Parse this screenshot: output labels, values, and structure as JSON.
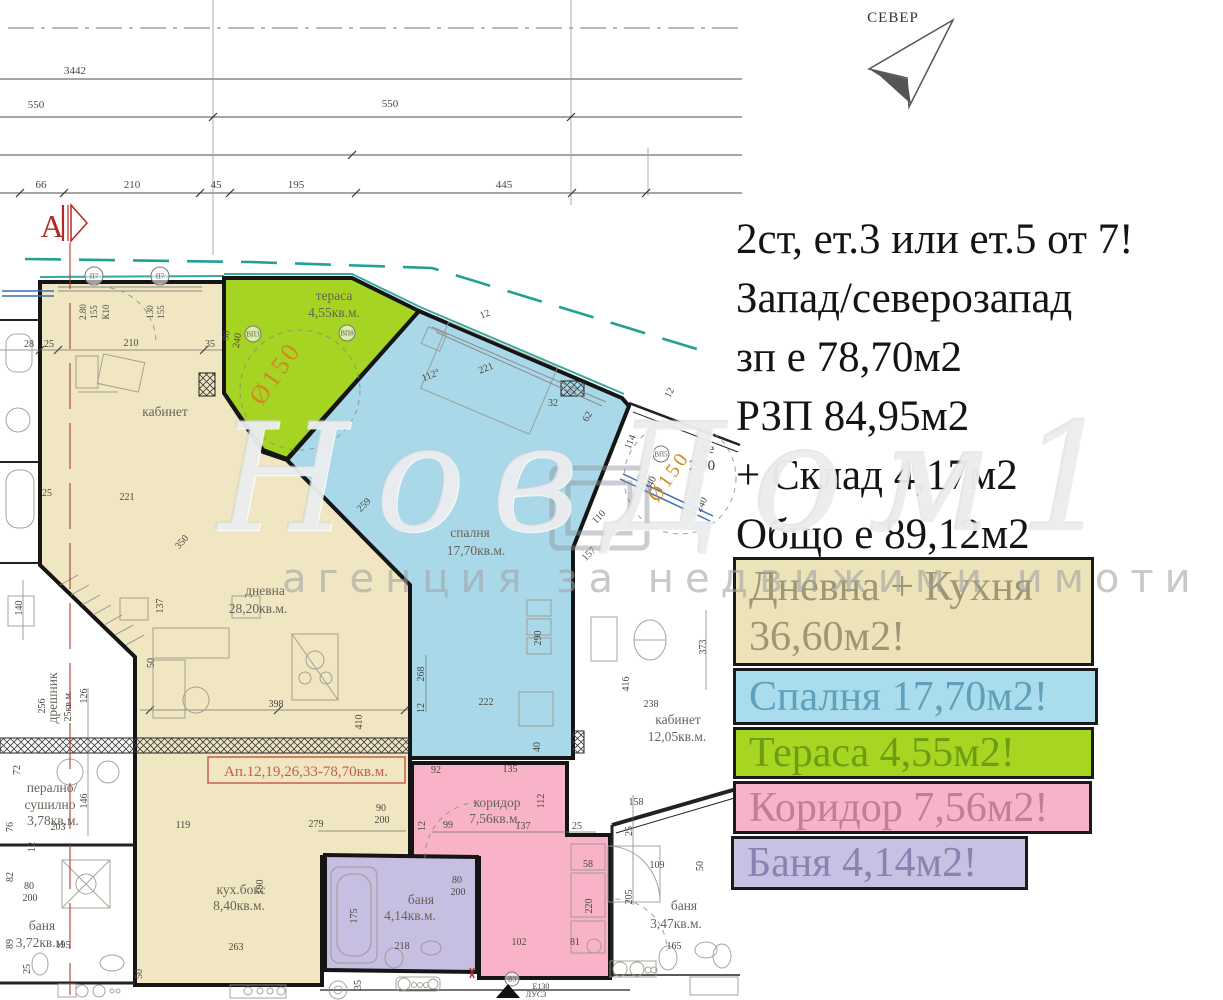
{
  "north": {
    "label": "СЕВЕР"
  },
  "info": {
    "lines": [
      "2ст, ет.3 или ет.5 от 7!",
      "Запад/северозапад",
      "зп е 78,70м2",
      "РЗП 84,95м2",
      "+ Склад 4,17м2",
      "Общо е 89,12м2"
    ]
  },
  "legend": {
    "boxes": [
      {
        "label": "living-kitchen",
        "lines": [
          "Дневна + Кухня",
          "36,60м2!"
        ],
        "x": 733,
        "y": 557,
        "w": 361,
        "h": 109,
        "fill": "#ece3b8",
        "color": "#9e9674"
      },
      {
        "label": "bedroom",
        "lines": [
          "Спалня 17,70м2!"
        ],
        "x": 733,
        "y": 668,
        "w": 365,
        "h": 57,
        "fill": "#a9dcec",
        "color": "#5fa0ba"
      },
      {
        "label": "terrace",
        "lines": [
          "Тераса 4,55м2!"
        ],
        "x": 733,
        "y": 727,
        "w": 361,
        "h": 52,
        "fill": "#a6d622",
        "color": "#6f9c14"
      },
      {
        "label": "corridor",
        "lines": [
          "Коридор 7,56м2!"
        ],
        "x": 733,
        "y": 781,
        "w": 359,
        "h": 53,
        "fill": "#f7b4c9",
        "color": "#c47d98"
      },
      {
        "label": "bath",
        "lines": [
          "Баня 4,14м2!"
        ],
        "x": 731,
        "y": 836,
        "w": 297,
        "h": 54,
        "fill": "#c7c1e3",
        "color": "#8a82b0"
      }
    ]
  },
  "watermark": {
    "brand": "НовДом1",
    "tagline": "агенция за недвижими имоти"
  },
  "plan": {
    "colors": {
      "wall": "#151515",
      "teal": "#21a093",
      "red": "#b22820",
      "orange": "#d08a1f",
      "dim": "#4a4841",
      "label": "#67645a"
    },
    "rooms": [
      {
        "name": "living-kitchen",
        "fill": "#f0e6c2",
        "points": "40,282 224,282 224,393 263,452 287,460 410,583 410,857 322,857 322,985 135,985 135,657 40,565"
      },
      {
        "name": "terrace",
        "fill": "#a6d422",
        "points": "224,278 352,278 419,311 287,459 263,450 224,393"
      },
      {
        "name": "bedroom",
        "fill": "#a9d9e9",
        "points": "419,311 622,398 629,406 573,548 573,758 410,758 410,585 287,460"
      },
      {
        "name": "corridor",
        "fill": "#f8b3c8",
        "points": "412,763 567,763 567,835 610,835 610,978 479,978 479,858 412,858"
      },
      {
        "name": "bath",
        "fill": "#c6bfe2",
        "points": "325,855 477,857 477,972 325,970"
      }
    ],
    "room_labels": [
      {
        "t": "кабинет",
        "x": 165,
        "y": 416
      },
      {
        "t": "дневна",
        "x": 265,
        "y": 595
      },
      {
        "t": "28,20кв.м.",
        "x": 258,
        "y": 613
      },
      {
        "t": "тераса",
        "x": 334,
        "y": 300
      },
      {
        "t": "4,55кв.м.",
        "x": 334,
        "y": 317
      },
      {
        "t": "спалня",
        "x": 470,
        "y": 537
      },
      {
        "t": "17,70кв.м.",
        "x": 476,
        "y": 555
      },
      {
        "t": "коридор",
        "x": 497,
        "y": 807
      },
      {
        "t": "7,56кв.м.",
        "x": 495,
        "y": 823
      },
      {
        "t": "баня",
        "x": 421,
        "y": 904
      },
      {
        "t": "4,14кв.м.",
        "x": 410,
        "y": 920
      },
      {
        "t": "кух.бокс",
        "x": 241,
        "y": 894
      },
      {
        "t": "8,40кв.м.",
        "x": 239,
        "y": 910
      },
      {
        "t": "кабинет",
        "x": 678,
        "y": 724
      },
      {
        "t": "12,05кв.м.",
        "x": 677,
        "y": 741
      },
      {
        "t": "баня",
        "x": 684,
        "y": 910
      },
      {
        "t": "3,47кв.м.",
        "x": 676,
        "y": 928
      },
      {
        "t": "перално/",
        "x": 52,
        "y": 792
      },
      {
        "t": "сушилно",
        "x": 50,
        "y": 809
      },
      {
        "t": "3,78кв.м.",
        "x": 53,
        "y": 825
      },
      {
        "t": "баня",
        "x": 42,
        "y": 930
      },
      {
        "t": "3,72кв.м",
        "x": 40,
        "y": 947
      },
      {
        "t": "дрешник",
        "x": 57,
        "y": 698,
        "r": -90
      }
    ],
    "unit_label": {
      "t": "Ап.12,19,26,33-78,70кв.м.",
      "x": 306,
      "y": 776,
      "box": [
        208,
        757,
        197,
        26
      ],
      "color": "#c2604a"
    },
    "top_labels": [
      {
        "t": "3442",
        "x": 75,
        "y": 74
      },
      {
        "t": "550",
        "x": 36,
        "y": 108
      },
      {
        "t": "550",
        "x": 390,
        "y": 107
      },
      {
        "t": "66",
        "x": 41,
        "y": 188
      },
      {
        "t": "210",
        "x": 132,
        "y": 188
      },
      {
        "t": "45",
        "x": 216,
        "y": 188
      },
      {
        "t": "195",
        "x": 296,
        "y": 188
      },
      {
        "t": "445",
        "x": 504,
        "y": 188
      }
    ],
    "dims": [
      {
        "t": "28",
        "x": 29,
        "y": 347
      },
      {
        "t": "25",
        "x": 49,
        "y": 347
      },
      {
        "t": "210",
        "x": 131,
        "y": 346
      },
      {
        "t": "35",
        "x": 210,
        "y": 347
      },
      {
        "t": "25",
        "x": 47,
        "y": 496
      },
      {
        "t": "221",
        "x": 127,
        "y": 500
      },
      {
        "t": "140",
        "x": 22,
        "y": 608,
        "r": -90
      },
      {
        "t": "137",
        "x": 163,
        "y": 606,
        "r": -90
      },
      {
        "t": "350",
        "x": 184,
        "y": 544,
        "r": -48
      },
      {
        "t": "50",
        "x": 154,
        "y": 663,
        "r": -90
      },
      {
        "t": "256",
        "x": 45,
        "y": 706,
        "r": -90
      },
      {
        "t": "25кв.м.",
        "x": 71,
        "y": 706,
        "r": -90
      },
      {
        "t": "126",
        "x": 87,
        "y": 696,
        "r": -90
      },
      {
        "t": "146",
        "x": 87,
        "y": 801,
        "r": -90
      },
      {
        "t": "203",
        "x": 58,
        "y": 830
      },
      {
        "t": "76",
        "x": 13,
        "y": 827,
        "r": -90
      },
      {
        "t": "12",
        "x": 35,
        "y": 847,
        "r": -90
      },
      {
        "t": "72",
        "x": 20,
        "y": 770,
        "r": -90
      },
      {
        "t": "80",
        "x": 29,
        "y": 889
      },
      {
        "t": "200",
        "x": 30,
        "y": 901
      },
      {
        "t": "82",
        "x": 13,
        "y": 877,
        "r": -90
      },
      {
        "t": "89",
        "x": 13,
        "y": 944,
        "r": -90
      },
      {
        "t": "195",
        "x": 63,
        "y": 948
      },
      {
        "t": "25",
        "x": 30,
        "y": 969,
        "r": -90
      },
      {
        "t": "190",
        "x": 263,
        "y": 887,
        "r": -90
      },
      {
        "t": "119",
        "x": 183,
        "y": 828
      },
      {
        "t": "279",
        "x": 316,
        "y": 827
      },
      {
        "t": "263",
        "x": 236,
        "y": 950
      },
      {
        "t": "50",
        "x": 142,
        "y": 974,
        "r": -90
      },
      {
        "t": "35",
        "x": 361,
        "y": 985,
        "r": -90
      },
      {
        "t": "398",
        "x": 276,
        "y": 707
      },
      {
        "t": "410",
        "x": 362,
        "y": 722,
        "r": -90
      },
      {
        "t": "90",
        "x": 381,
        "y": 811
      },
      {
        "t": "200",
        "x": 382,
        "y": 823
      },
      {
        "t": "221",
        "x": 487,
        "y": 371,
        "r": -22
      },
      {
        "t": "112°",
        "x": 432,
        "y": 378,
        "r": -22
      },
      {
        "t": "12",
        "x": 486,
        "y": 317,
        "r": -22
      },
      {
        "t": "32",
        "x": 553,
        "y": 406
      },
      {
        "t": "62",
        "x": 590,
        "y": 418,
        "r": -62
      },
      {
        "t": "259",
        "x": 366,
        "y": 507,
        "r": -46
      },
      {
        "t": "268",
        "x": 424,
        "y": 674,
        "r": -90
      },
      {
        "t": "12",
        "x": 424,
        "y": 708,
        "r": -90
      },
      {
        "t": "290",
        "x": 541,
        "y": 638,
        "r": -90
      },
      {
        "t": "222",
        "x": 486,
        "y": 705
      },
      {
        "t": "40",
        "x": 540,
        "y": 747,
        "r": -90
      },
      {
        "t": "90",
        "x": 229,
        "y": 336,
        "r": -80
      },
      {
        "t": "240",
        "x": 240,
        "y": 341,
        "r": -80
      },
      {
        "t": "90",
        "x": 645,
        "y": 477,
        "r": -62
      },
      {
        "t": "240",
        "x": 653,
        "y": 485,
        "r": -62
      },
      {
        "t": "114",
        "x": 633,
        "y": 443,
        "r": -68
      },
      {
        "t": "200",
        "x": 696,
        "y": 498,
        "r": -62
      },
      {
        "t": "240",
        "x": 704,
        "y": 506,
        "r": -62
      },
      {
        "t": "110",
        "x": 601,
        "y": 519,
        "r": -46
      },
      {
        "t": "157",
        "x": 591,
        "y": 556,
        "r": -46
      },
      {
        "t": "12",
        "x": 672,
        "y": 394,
        "r": -62
      },
      {
        "t": "373",
        "x": 706,
        "y": 647,
        "r": -90
      },
      {
        "t": "416",
        "x": 629,
        "y": 684,
        "r": -90
      },
      {
        "t": "238",
        "x": 651,
        "y": 707
      },
      {
        "t": "158",
        "x": 636,
        "y": 805
      },
      {
        "t": "25",
        "x": 632,
        "y": 831,
        "r": -90
      },
      {
        "t": "109",
        "x": 657,
        "y": 868
      },
      {
        "t": "205",
        "x": 632,
        "y": 897,
        "r": -90
      },
      {
        "t": "165",
        "x": 674,
        "y": 949
      },
      {
        "t": "50",
        "x": 703,
        "y": 866,
        "r": -90
      },
      {
        "t": "92",
        "x": 436,
        "y": 773
      },
      {
        "t": "135",
        "x": 510,
        "y": 772
      },
      {
        "t": "12",
        "x": 425,
        "y": 826,
        "r": -90
      },
      {
        "t": "99",
        "x": 448,
        "y": 828
      },
      {
        "t": "137",
        "x": 523,
        "y": 829
      },
      {
        "t": "112",
        "x": 544,
        "y": 801,
        "r": -90
      },
      {
        "t": "25",
        "x": 577,
        "y": 829
      },
      {
        "t": "58",
        "x": 588,
        "y": 867
      },
      {
        "t": "220",
        "x": 592,
        "y": 906,
        "r": -90
      },
      {
        "t": "80",
        "x": 457,
        "y": 883
      },
      {
        "t": "200",
        "x": 458,
        "y": 895
      },
      {
        "t": "102",
        "x": 519,
        "y": 945
      },
      {
        "t": "81",
        "x": 575,
        "y": 945
      },
      {
        "t": "218",
        "x": 402,
        "y": 949
      },
      {
        "t": "175",
        "x": 357,
        "y": 916,
        "r": -90
      },
      {
        "t": "2.80",
        "x": 86,
        "y": 312,
        "r": -90,
        "s": 9
      },
      {
        "t": "155",
        "x": 97,
        "y": 312,
        "r": -90,
        "s": 9
      },
      {
        "t": "К10",
        "x": 109,
        "y": 312,
        "r": -90,
        "s": 9
      },
      {
        "t": "130",
        "x": 153,
        "y": 312,
        "r": -90,
        "s": 9
      },
      {
        "t": "155",
        "x": 164,
        "y": 312,
        "r": -90,
        "s": 9
      },
      {
        "t": "те",
        "x": 708,
        "y": 453,
        "s": 14,
        "c": "#3a3a36"
      },
      {
        "t": "2,90",
        "x": 702,
        "y": 470,
        "s": 15,
        "c": "#3a3a36"
      }
    ],
    "circles": [
      {
        "t": "П7",
        "x": 94,
        "y": 276,
        "r": 9
      },
      {
        "t": "П7",
        "x": 160,
        "y": 276,
        "r": 9
      },
      {
        "t": "ВП3",
        "x": 253,
        "y": 334,
        "r": 8
      },
      {
        "t": "ВП8",
        "x": 347,
        "y": 333,
        "r": 8
      },
      {
        "t": "ВП5",
        "x": 661,
        "y": 454,
        "r": 8
      },
      {
        "t": "В3",
        "x": 512,
        "y": 979,
        "r": 7
      }
    ],
    "o150_text": "Ø150",
    "o150": [
      {
        "x": 282,
        "y": 378,
        "r": -55,
        "s": 26
      },
      {
        "x": 674,
        "y": 480,
        "r": -55,
        "s": 20
      }
    ],
    "note": {
      "l1": "Е130",
      "l2": "ЛУС3"
    },
    "section_marker": "А"
  }
}
